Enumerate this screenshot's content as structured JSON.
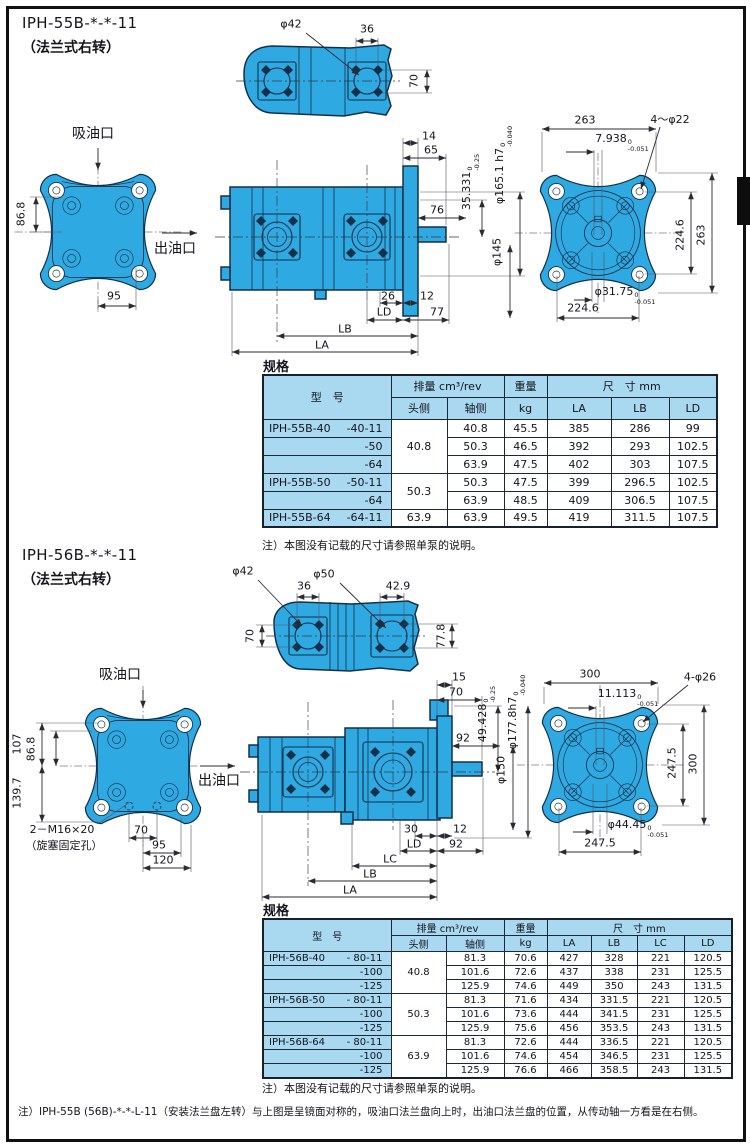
{
  "page": {
    "bottom_note": "注）IPH-55B (56B)-*-*-L-11（安装法兰盘左转）与上图是呈镜面对称的，吸油口法兰盘向上时，出油口法兰盘的位置，从传动轴一方看是在右侧。"
  },
  "colors": {
    "pump_blue": "#2fa9e1",
    "table_header_blue": "#a9d8f1",
    "line_dark": "#13304a"
  },
  "s1": {
    "title": "IPH-55B-*-*-11",
    "subtitle": "（法兰式右转）",
    "suction": "吸油口",
    "outlet": "出油口",
    "spec_heading": "规格",
    "note": "注）本图没有记载的尺寸请参照单泵的说明。",
    "top": {
      "d42": "φ42",
      "w36": "36",
      "h70": "70"
    },
    "front": {
      "v868": "86.8",
      "w95": "95"
    },
    "side": {
      "n14": "14",
      "n65": "65",
      "t35": {
        "v": "35.331",
        "hi": "0",
        "lo": "-0.25"
      },
      "t165": {
        "v": "φ165.1 h7",
        "hi": "0",
        "lo": "-0.040"
      },
      "n76": "76",
      "d145": "φ145",
      "n26": "26",
      "n12": "12",
      "ld": "LD",
      "n77": "77",
      "lb": "LB",
      "la": "LA"
    },
    "rear": {
      "w263": "263",
      "t7938": {
        "v": "7.938",
        "hi": "0",
        "lo": "-0.051"
      },
      "bolt": "4～φ22",
      "v2246": "224.6",
      "v263": "263",
      "t3175": {
        "v": "φ31.75",
        "hi": "0",
        "lo": "-0.051"
      },
      "h2246": "224.6"
    }
  },
  "s2": {
    "title": "IPH-56B-*-*-11",
    "subtitle": "（法兰式右转）",
    "suction": "吸油口",
    "outlet": "出油口",
    "spec_heading": "规格",
    "note": "注）本图没有记载的尺寸请参照单泵的说明。",
    "top": {
      "d42": "φ42",
      "d50": "φ50",
      "w36": "36",
      "w429": "42.9",
      "h70": "70",
      "h778": "77.8"
    },
    "front": {
      "v107": "107",
      "v868": "86.8",
      "v1397": "139.7",
      "m16": "2－M16×20",
      "m16b": "（旋塞固定孔）",
      "w70": "70",
      "w95": "95",
      "w120": "120"
    },
    "side": {
      "n15": "15",
      "n70": "70",
      "t49": {
        "v": "49.428",
        "hi": "0",
        "lo": "-0.25"
      },
      "t177": {
        "v": "φ177.8h7",
        "hi": "0",
        "lo": "-0.040"
      },
      "n92a": "92",
      "d150": "φ150",
      "n30": "30",
      "n12": "12",
      "ld": "LD",
      "n92b": "92",
      "lc": "LC",
      "lb": "LB",
      "la": "LA"
    },
    "rear": {
      "w300": "300",
      "t11113": {
        "v": "11.113",
        "hi": "0",
        "lo": "-0.051"
      },
      "bolt": "4-φ26",
      "v2475": "247.5",
      "v300": "300",
      "t4445": {
        "v": "φ44.45",
        "hi": "0",
        "lo": "-0.051"
      },
      "h2475": "247.5"
    }
  },
  "table1": {
    "headers": {
      "model": "型　号",
      "disp": "排量  cm³/rev",
      "head": "头侧",
      "shaft": "轴侧",
      "weight": "重量",
      "weight_unit": "kg",
      "dims": "尺　寸 mm",
      "cols": [
        "LA",
        "LB",
        "LD"
      ]
    },
    "rows": [
      {
        "model": "IPH-55B-40",
        "variant": "-40-11",
        "head": "40.8",
        "headspan": 3,
        "cells": [
          "40.8",
          "45.5",
          "385",
          "286",
          "99"
        ]
      },
      {
        "model": "",
        "variant": "-50",
        "cells": [
          "50.3",
          "46.5",
          "392",
          "293",
          "102.5"
        ]
      },
      {
        "model": "",
        "variant": "-64",
        "cells": [
          "63.9",
          "47.5",
          "402",
          "303",
          "107.5"
        ]
      },
      {
        "model": "IPH-55B-50",
        "variant": "-50-11",
        "head": "50.3",
        "headspan": 2,
        "cells": [
          "50.3",
          "47.5",
          "399",
          "296.5",
          "102.5"
        ]
      },
      {
        "model": "",
        "variant": "-64",
        "cells": [
          "63.9",
          "48.5",
          "409",
          "306.5",
          "107.5"
        ]
      },
      {
        "model": "IPH-55B-64",
        "variant": "-64-11",
        "head": "63.9",
        "headspan": 1,
        "cells": [
          "63.9",
          "49.5",
          "419",
          "311.5",
          "107.5"
        ]
      }
    ]
  },
  "table2": {
    "headers": {
      "model": "型　号",
      "disp": "排量  cm³/rev",
      "head": "头侧",
      "shaft": "轴侧",
      "weight": "重量",
      "weight_unit": "kg",
      "dims": "尺　寸  mm",
      "cols": [
        "LA",
        "LB",
        "LC",
        "LD"
      ]
    },
    "rows": [
      {
        "model": "IPH-56B-40",
        "variant": "- 80-11",
        "head": "40.8",
        "headspan": 3,
        "cells": [
          "81.3",
          "70.6",
          "427",
          "328",
          "221",
          "120.5"
        ]
      },
      {
        "model": "",
        "variant": "-100",
        "cells": [
          "101.6",
          "72.6",
          "437",
          "338",
          "231",
          "125.5"
        ]
      },
      {
        "model": "",
        "variant": "-125",
        "cells": [
          "125.9",
          "74.6",
          "449",
          "350",
          "243",
          "131.5"
        ]
      },
      {
        "model": "IPH-56B-50",
        "variant": "- 80-11",
        "head": "50.3",
        "headspan": 3,
        "cells": [
          "81.3",
          "71.6",
          "434",
          "331.5",
          "221",
          "120.5"
        ]
      },
      {
        "model": "",
        "variant": "-100",
        "cells": [
          "101.6",
          "73.6",
          "444",
          "341.5",
          "231",
          "125.5"
        ]
      },
      {
        "model": "",
        "variant": "-125",
        "cells": [
          "125.9",
          "75.6",
          "456",
          "353.5",
          "243",
          "131.5"
        ]
      },
      {
        "model": "IPH-56B-64",
        "variant": "- 80-11",
        "head": "63.9",
        "headspan": 3,
        "cells": [
          "81.3",
          "72.6",
          "444",
          "336.5",
          "221",
          "120.5"
        ]
      },
      {
        "model": "",
        "variant": "-100",
        "cells": [
          "101.6",
          "74.6",
          "454",
          "346.5",
          "231",
          "125.5"
        ]
      },
      {
        "model": "",
        "variant": "-125",
        "cells": [
          "125.9",
          "76.6",
          "466",
          "358.5",
          "243",
          "131.5"
        ]
      }
    ]
  }
}
